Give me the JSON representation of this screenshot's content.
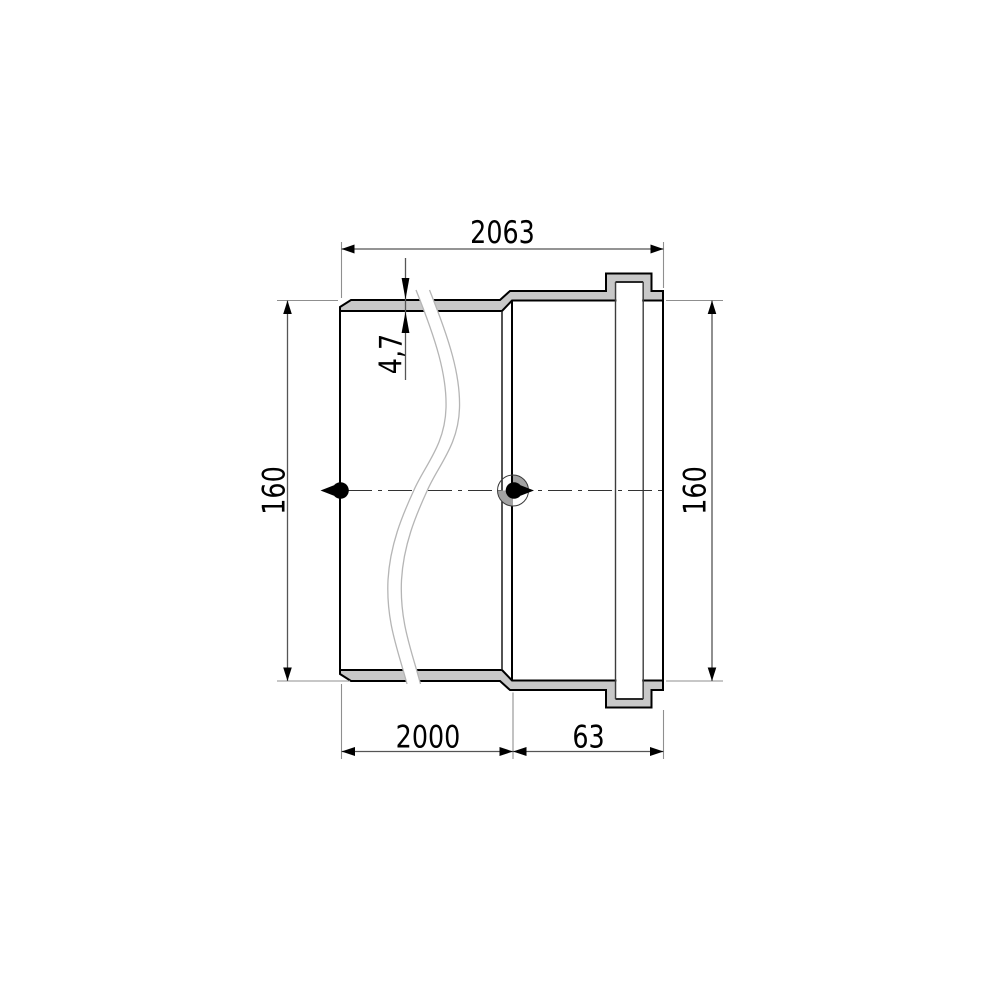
{
  "drawing": {
    "type": "pipe-section-technical-drawing",
    "dimensions": {
      "total_length": "2063",
      "wall_thickness": "4,7",
      "diameter_left": "160",
      "diameter_right": "160",
      "pipe_length": "2000",
      "socket_length": "63"
    },
    "colors": {
      "background": "#ffffff",
      "wall_fill": "#c8c8c8",
      "outline": "#000000",
      "extension_line": "#8f8f8f",
      "dimension_line": "#555555",
      "break_line": "#b5b5b5",
      "marker_shade": "#a2a2a2"
    }
  }
}
